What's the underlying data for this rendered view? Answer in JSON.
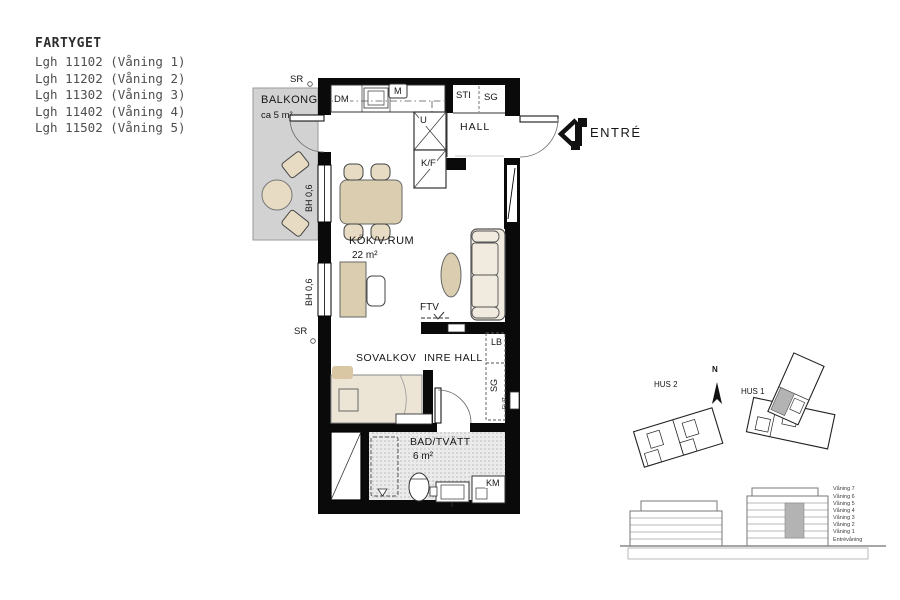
{
  "title_block": {
    "project": "FARTYGET",
    "apartments": [
      "Lgh 11102 (Våning 1)",
      "Lgh 11202 (Våning 2)",
      "Lgh 11302 (Våning 3)",
      "Lgh 11402 (Våning 4)",
      "Lgh 11502 (Våning 5)"
    ]
  },
  "plan": {
    "balcony": {
      "name": "BALKONG",
      "area": "ca 5 m²"
    },
    "kitchen_living": {
      "name": "KÖK/V.RUM",
      "area": "22 m²"
    },
    "hall": {
      "name": "HALL"
    },
    "sleeping_alcove": {
      "name": "SOVALKOV"
    },
    "inner_hall": {
      "name": "INRE HALL"
    },
    "bathroom": {
      "name": "BAD/TVÄTT",
      "area": "6 m²"
    },
    "entrance": {
      "name": "ENTRÉ"
    },
    "markers": {
      "sr_top": "SR",
      "sr_left": "SR",
      "dm": "DM",
      "m": "M",
      "sti": "STI",
      "sg_hall": "SG",
      "u": "U",
      "kf": "K/F",
      "bh_upper": "BH 0,6",
      "bh_lower": "BH 0,6",
      "ftv": "FTV",
      "lb": "LB",
      "sg_inner": "SG",
      "el_it": "EL/IT",
      "km": "KM"
    }
  },
  "site_plan": {
    "north_label": "N",
    "hus1_label": "HUS 1",
    "hus2_label": "HUS 2"
  },
  "elevations": {
    "floor_labels": [
      "Våning 7",
      "Våning 6",
      "Våning 5",
      "Våning 4",
      "Våning 3",
      "Våning 2",
      "Våning 1",
      "Entrévåning"
    ]
  },
  "colors": {
    "wall": "#0a0a0a",
    "beige": "#dbcdb0",
    "beige_light": "#e7dbc4",
    "cream": "#f1ebdf",
    "balcony_gray": "#d2d2d2",
    "bath_gray": "#ebebeb",
    "site_gray": "#b3b3b3",
    "text": "#161616"
  }
}
